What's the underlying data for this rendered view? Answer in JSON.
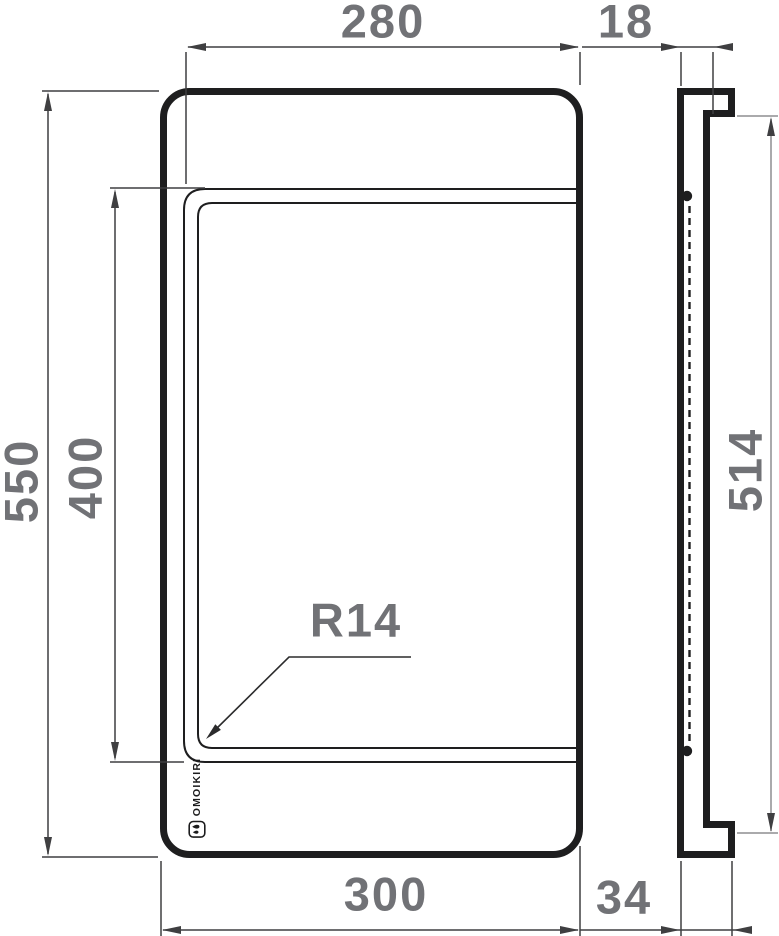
{
  "dimensions": {
    "inner_width": "280",
    "lip_thickness": "18",
    "outer_height": "550",
    "inner_height": "400",
    "hook_span": "514",
    "corner_radius": "R14",
    "outer_width": "300",
    "profile_depth": "34"
  },
  "logo": {
    "brand": "OMOIKIRI"
  },
  "colors": {
    "outline": "#1e1e1f",
    "dimension": "#3f3f41",
    "dimension_light": "#8e8e90",
    "label_gray": "#717276",
    "background": "#ffffff"
  }
}
